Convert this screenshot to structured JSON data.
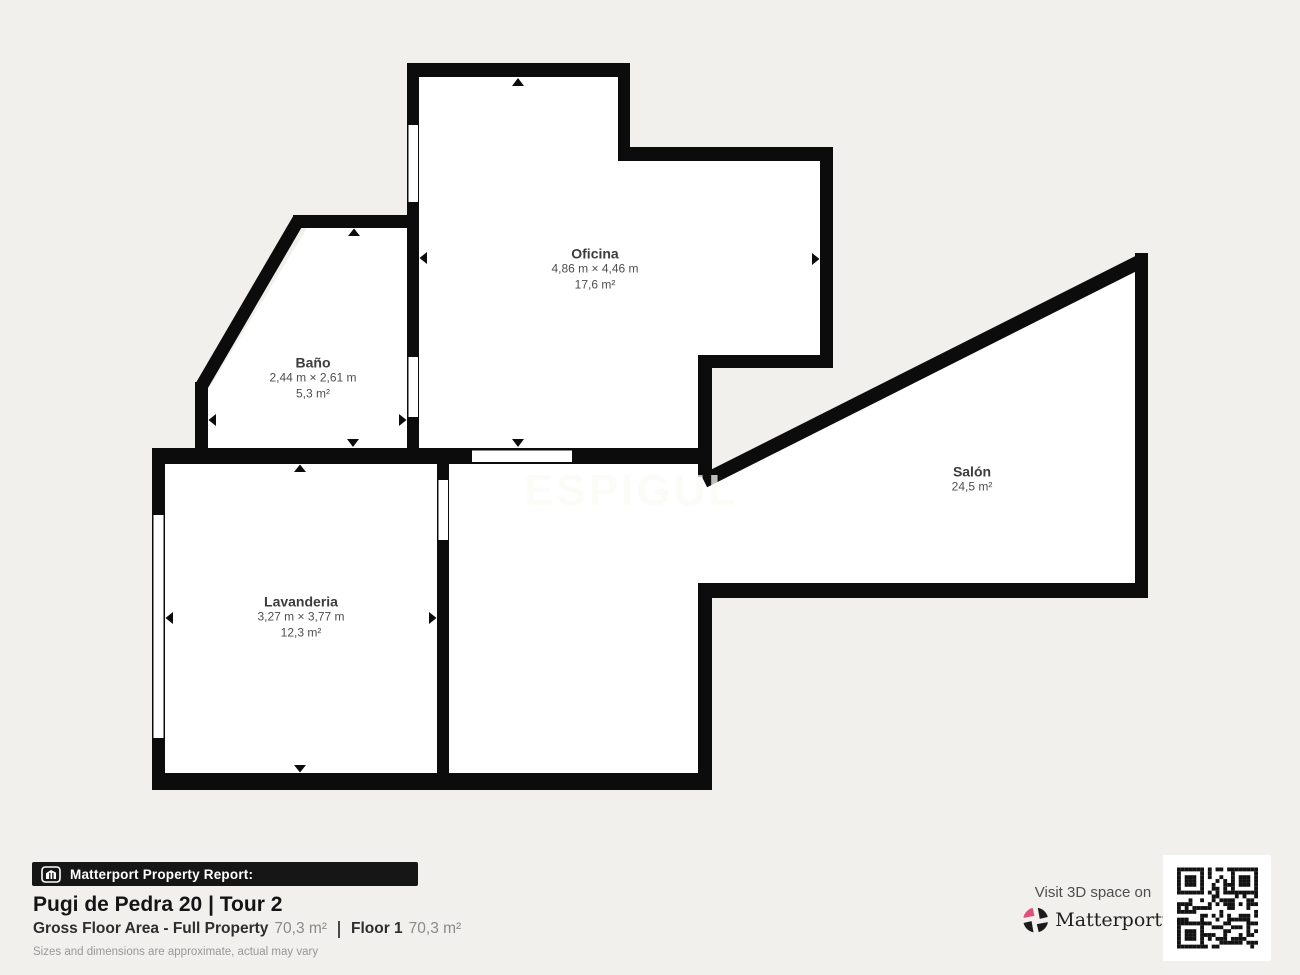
{
  "floor_plan": {
    "watermark": "ESPIGUL",
    "rooms": [
      {
        "name": "Oficina",
        "dimensions": "4,86 m × 4,46 m",
        "area": "17,6 m²"
      },
      {
        "name": "Baño",
        "dimensions": "2,44 m × 2,61 m",
        "area": "5,3 m²"
      },
      {
        "name": "Lavanderia",
        "dimensions": "3,27 m × 3,77 m",
        "area": "12,3 m²"
      },
      {
        "name": "Salón",
        "area": "24,5 m²"
      }
    ]
  },
  "footer": {
    "report_badge": "Matterport Property Report:",
    "title": "Pugi de Pedra 20 | Tour 2",
    "gross_floor_area_label": "Gross Floor Area - Full Property",
    "gross_floor_area_value": "70,3 m²",
    "floor_label": "Floor 1",
    "floor_value": "70,3 m²",
    "disclaimer": "Sizes and dimensions are approximate, actual may vary",
    "visit_text": "Visit 3D space on",
    "brand": "Matterport",
    "brand_tm": "ʼ"
  },
  "icons": {
    "badge_icon": "matterport-house-icon",
    "brand_icon": "matterport-pinwheel-icon",
    "qr": "qr-code"
  },
  "colors": {
    "background": "#f1f0ed",
    "wall": "#0c0c0c",
    "room_fill": "#ffffff",
    "brand_pink": "#e0507a",
    "footer_bar": "#161616"
  }
}
